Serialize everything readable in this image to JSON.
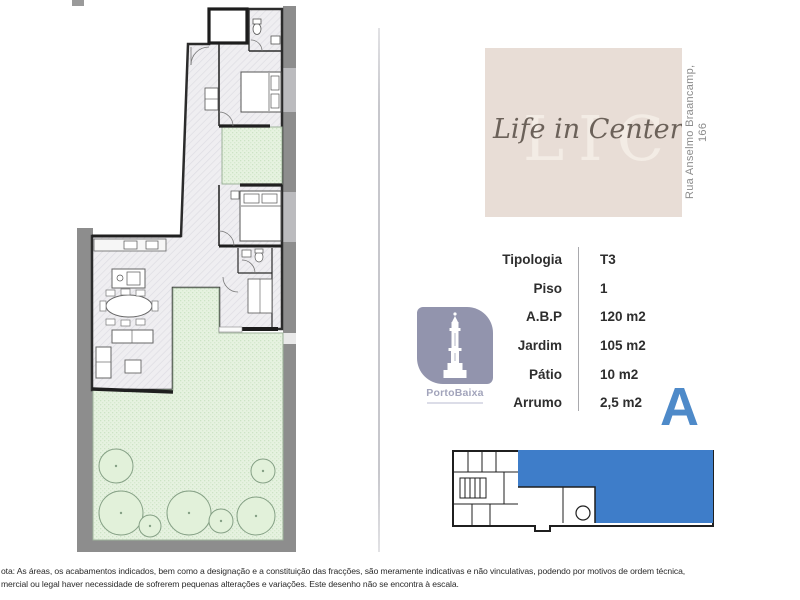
{
  "branding": {
    "watermark": "LIC",
    "title": "Life in Center",
    "address_line1": "Rua Anselmo Braancamp,",
    "address_line2": "166",
    "logo_text": "PortoBaixa"
  },
  "unit": {
    "letter": "A"
  },
  "specs": {
    "rows": [
      {
        "label": "Tipologia",
        "value": "T3"
      },
      {
        "label": "Piso",
        "value": "1"
      },
      {
        "label": "A.B.P",
        "value": "120 m2"
      },
      {
        "label": "Jardim",
        "value": "105 m2"
      },
      {
        "label": "Pátio",
        "value": "10 m2"
      },
      {
        "label": "Arrumo",
        "value": "2,5 m2"
      }
    ]
  },
  "disclaimer": {
    "line1": "ota: As áreas, os acabamentos indicados, bem como a designação e a constituição das fracções, são meramente indicativas e não vinculativas, podendo por motivos de ordem técnica,",
    "line2": "mercial ou legal haver necessidade de sofrerem pequenas alterações e variações. Este desenho não se encontra à escala."
  },
  "colors": {
    "accent_blue": "#3e7dc9",
    "letter_blue": "#4e8ac9",
    "beige_box": "#e8ddd6",
    "logo_purple": "#9294ad",
    "garden_green": "#e6f2e0",
    "site_wall_gray": "#8d8d8d"
  }
}
